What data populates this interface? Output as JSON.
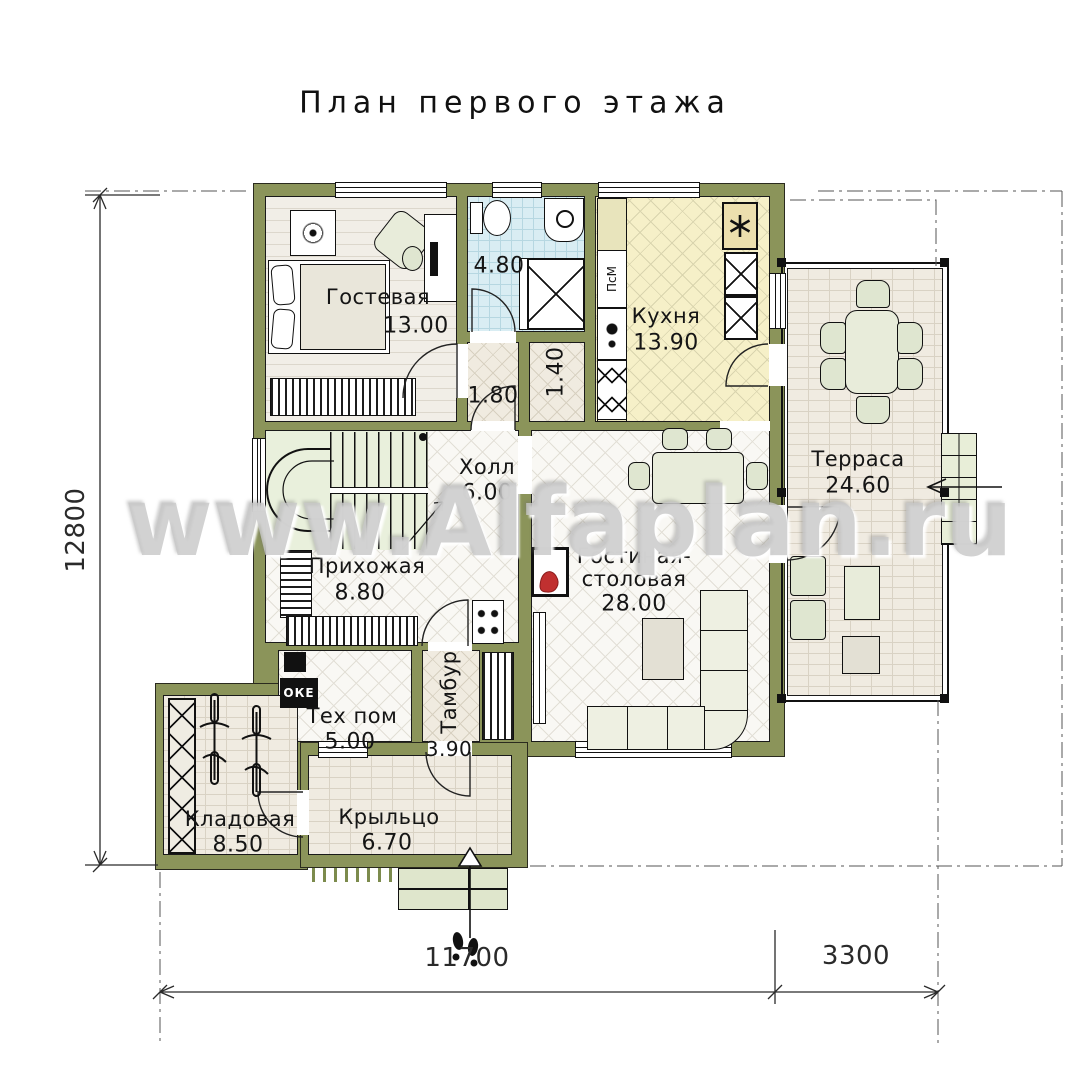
{
  "title": "План первого этажа",
  "watermark": "www.Alfaplan.ru",
  "rooms": {
    "guest": {
      "name": "Гостевая",
      "area": "13.00"
    },
    "bathroom": {
      "area": "4.80"
    },
    "corridor": {
      "area": "1.80"
    },
    "closet": {
      "area": "1.40"
    },
    "kitchen": {
      "name": "Кухня",
      "area": "13.90"
    },
    "hall": {
      "name": "Холл",
      "area": "6.00"
    },
    "terrace": {
      "name": "Терраса",
      "area": "24.60"
    },
    "hallway": {
      "name": "Прихожая",
      "area": "8.80"
    },
    "living": {
      "name_line1": "Гостиная-",
      "name_line2": "столовая",
      "area": "28.00"
    },
    "tech": {
      "name": "Тех пом",
      "area": "5.00"
    },
    "tambour": {
      "name": "Тамбур",
      "area": "3.90"
    },
    "storage": {
      "name": "Кладовая",
      "area": "8.50"
    },
    "porch": {
      "name": "Крыльцо",
      "area": "6.70"
    }
  },
  "dimensions": {
    "height_total": "12800",
    "width_main": "11700",
    "width_terrace": "3300"
  },
  "appliances": {
    "dishwasher": "ПсМ",
    "boiler": "ОКЕ"
  },
  "colors": {
    "wall": "#8b945a",
    "kitchen_floor": "#f6f0c8",
    "bath_floor": "#d9edf3",
    "flame": "#c03030"
  }
}
